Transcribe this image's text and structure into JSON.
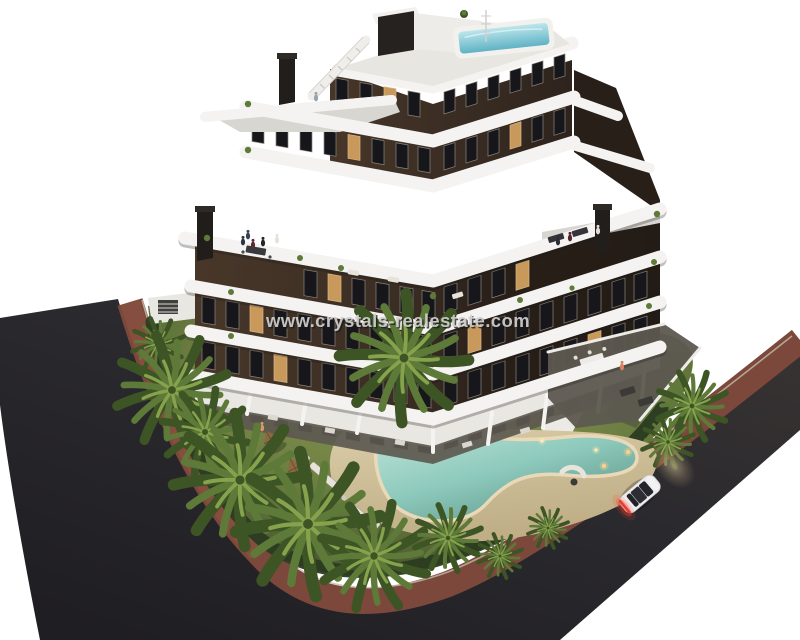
{
  "image": {
    "kind": "architectural-3d-render",
    "description": "Dusk aerial render of a modern curved-balcony apartment block with garden, free-form pool, palm trees, perimeter roads and a white car",
    "width_px": 800,
    "height_px": 640
  },
  "watermark": {
    "text": "www.crystals-realestate.com"
  },
  "palette": {
    "asphalt": "#2b2a2e",
    "sidewalk": "#7c483b",
    "sidewalk_light": "#8d5443",
    "curb": "#c6bca9",
    "lawn": "#6f8040",
    "lawn_light": "#8d9d57",
    "lawn_dark": "#42512c",
    "hedge": "#2b3b21",
    "sand": "#d3c29c",
    "pool": "#8ecabd",
    "pool_light": "#c2e6da",
    "pool_deep": "#5e978a",
    "pool_rim": "#ead9b8",
    "soil": "#3c3627",
    "facade": "#3e3026",
    "facade_dark": "#281f19",
    "band": "#f4f3f1",
    "terrace": "#d8d6d1",
    "wall": "#e9e7e2",
    "patio": "#5d5950",
    "window": "#17171b",
    "window_lit": "#c9995c",
    "frame": "#8a867e",
    "palm": "#5d7a38",
    "palm_light": "#86a24c",
    "palm_dark": "#3d5425",
    "trunk": "#6b5b43",
    "umbrella": "#8a6a42",
    "umbrella_dark": "#6b4f30",
    "lounger": "#e7e3da",
    "car": "#ebebed",
    "car_roof": "#2b2d32",
    "taillight": "#d23b2e",
    "headlight": "#e8d4a4",
    "roof_pool": "#62b4c6",
    "watermark_color": "#d2d0ce"
  }
}
